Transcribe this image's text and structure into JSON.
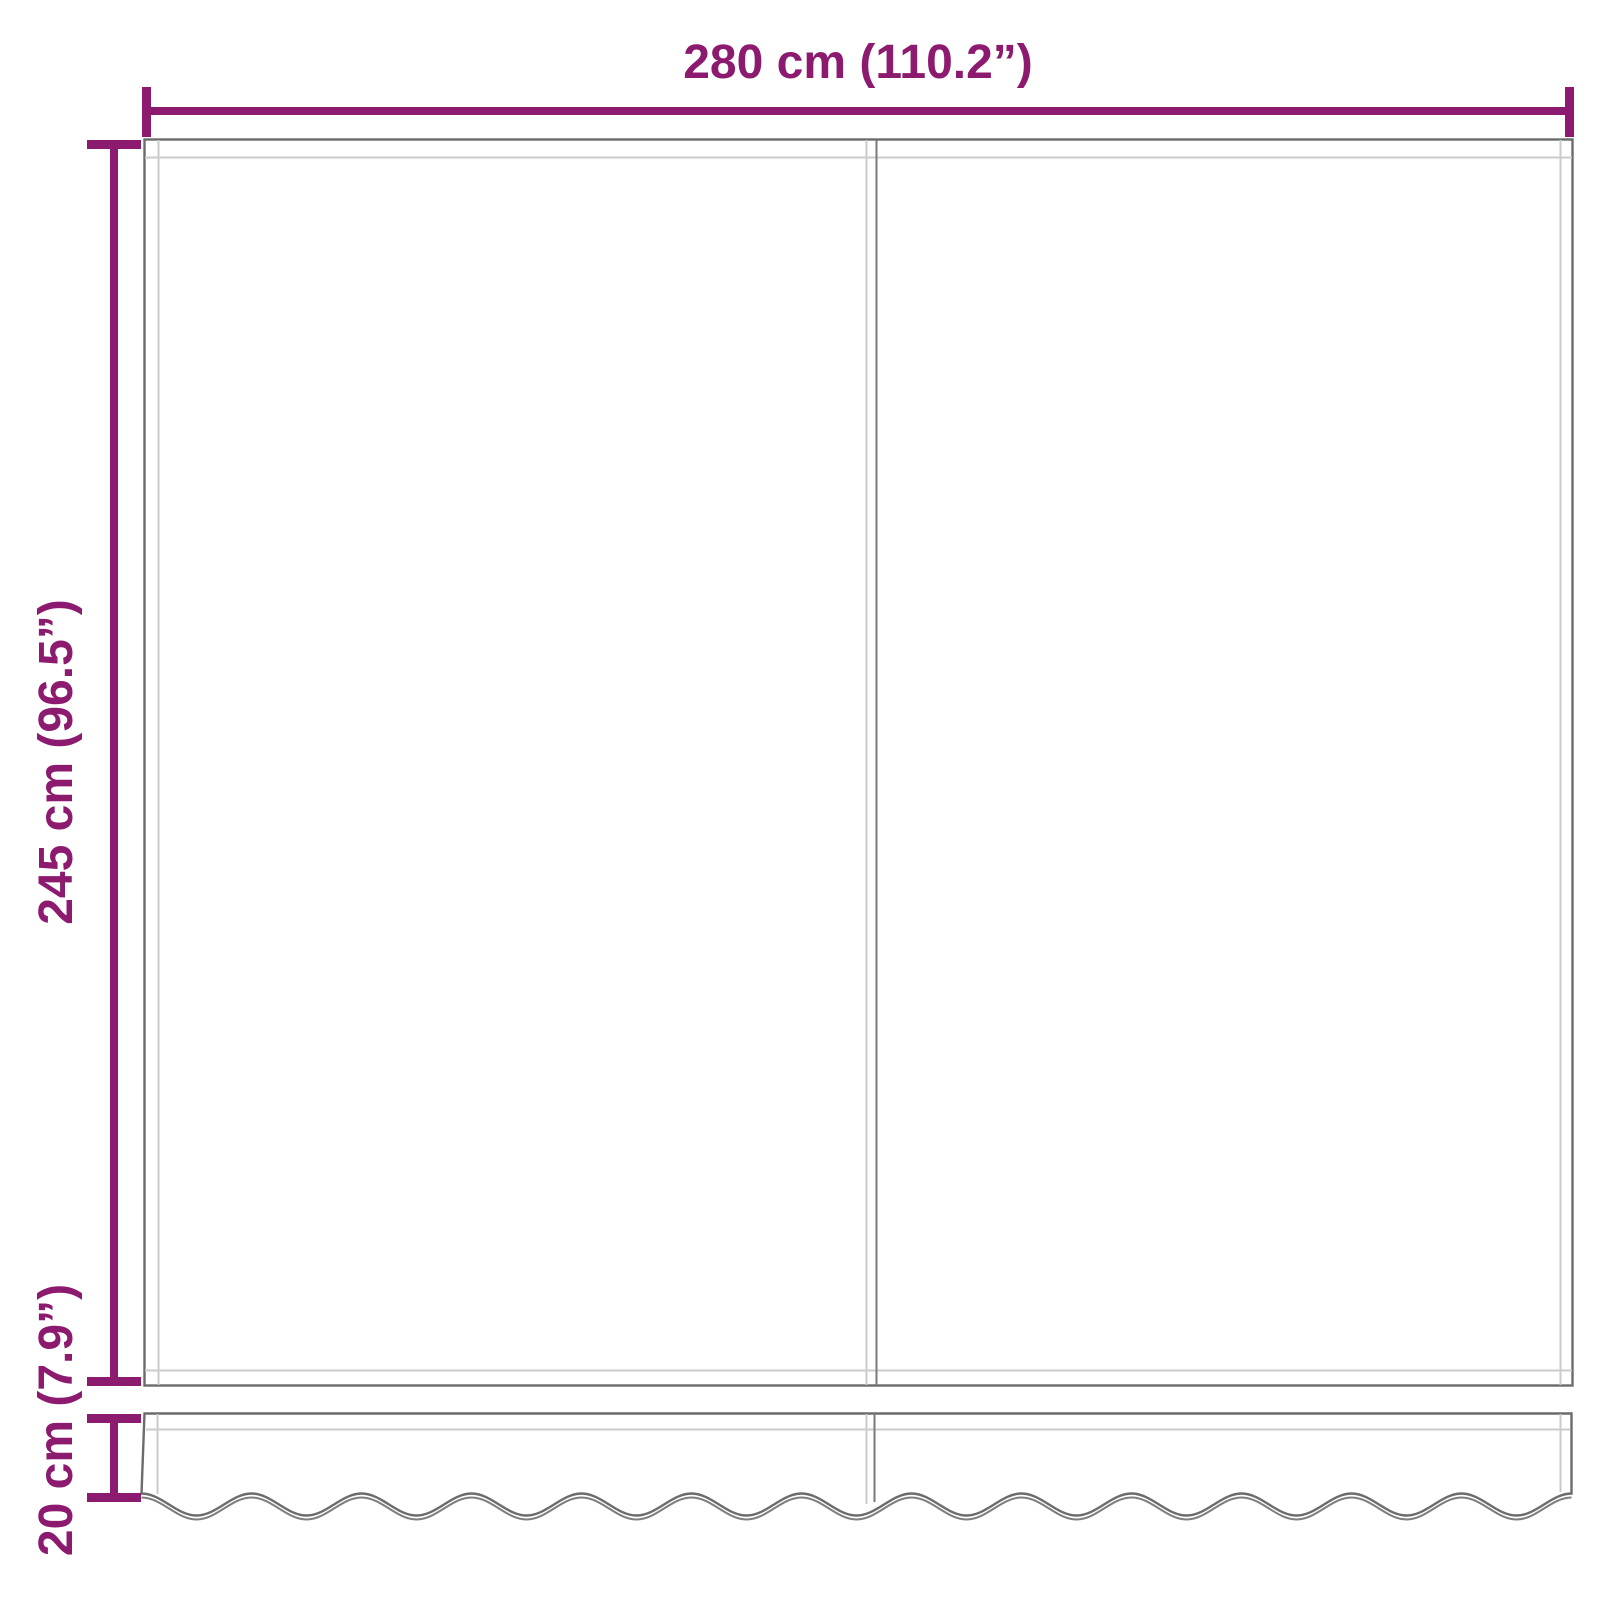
{
  "diagram": {
    "type": "awning-replacement-fabric-dimension-diagram",
    "colors": {
      "accent": "#8C1A6E",
      "outline": "#6B6B6B",
      "soft": "#7E7E7E",
      "hem": "#CBCBCB",
      "seam": "#7A7A7A",
      "background": "#FFFFFF"
    },
    "dimensions": {
      "width": {
        "label": "280 cm (110.2”)",
        "cm": 280,
        "inches": 110.2
      },
      "height": {
        "label": "245 cm (96.5”)",
        "cm": 245,
        "inches": 96.5
      },
      "valance": {
        "label": "20 cm (7.9”)",
        "cm": 20,
        "inches": 7.9
      }
    },
    "parts": {
      "canopy": "awning canopy panel (two fabric widths with center seam)",
      "valance": "scalloped valance strip"
    }
  }
}
